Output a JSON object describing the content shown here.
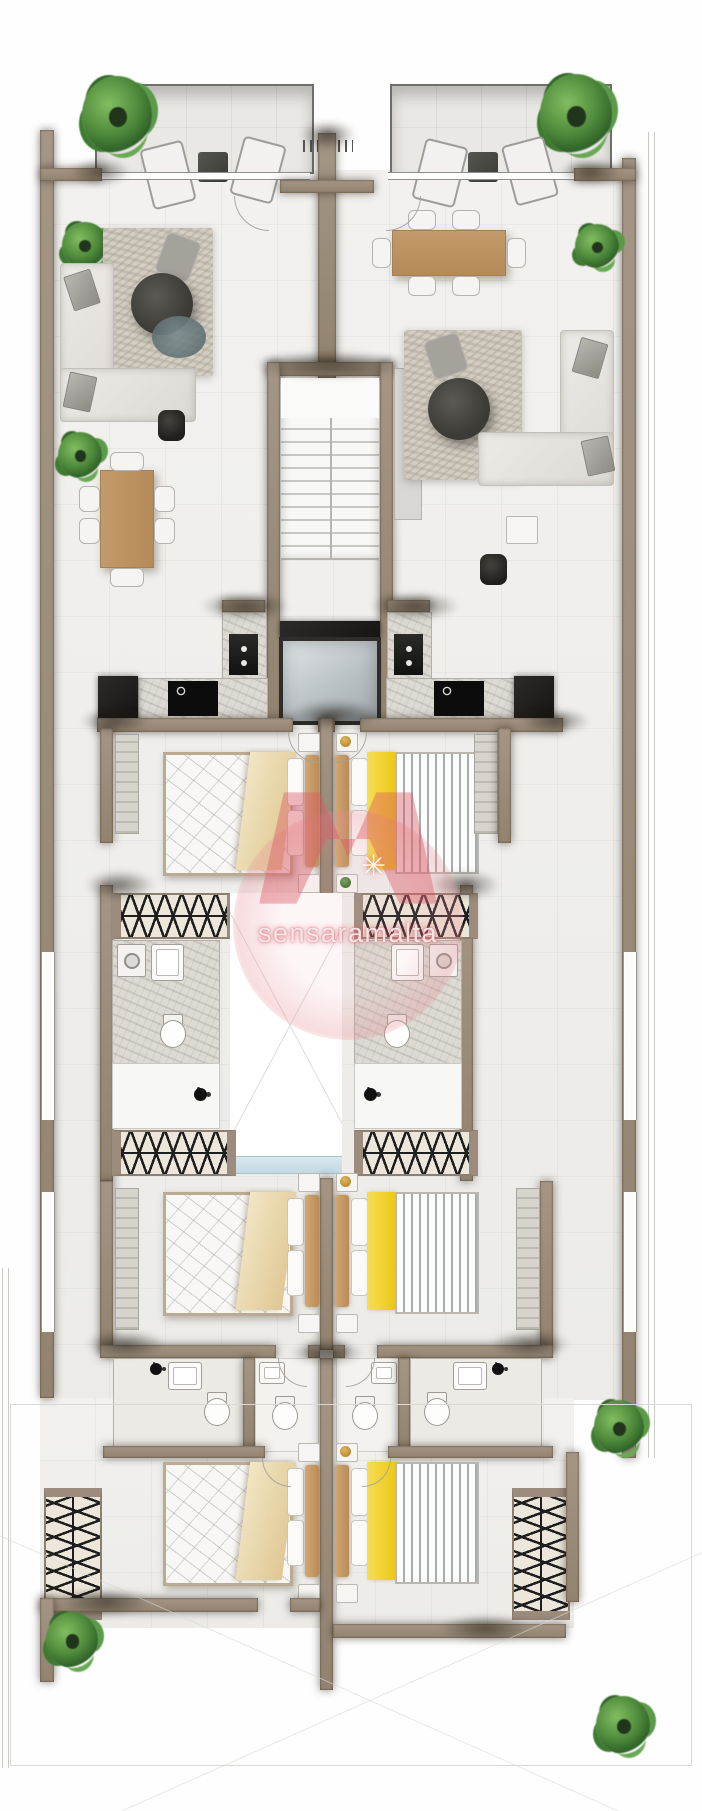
{
  "watermark": {
    "text": "sensaramalta",
    "star": "✳",
    "color": "#db5864"
  },
  "plan": {
    "type": "residential-floor-plan",
    "view": "top-down architectural render, two mirrored apartments around a central core",
    "core": [
      "staircase",
      "elevator",
      "light-well"
    ],
    "apartments": [
      {
        "id": "left",
        "rooms": [
          "terrace",
          "living-room",
          "dining-area",
          "kitchen",
          "bedroom-1",
          "walk-in-wardrobe",
          "bathroom-1",
          "bedroom-2",
          "bathroom-2",
          "bedroom-3"
        ],
        "furniture": [
          "potted-plant",
          "sun-lounger",
          "sun-lounger",
          "side-table",
          "corner-sofa",
          "rug",
          "round-coffee-table",
          "accent-chair",
          "floor-lamp",
          "dining-table-6-chairs",
          "fridge",
          "cooktop",
          "kitchen-sink",
          "double-bed-beige",
          "nightstands",
          "wardrobe-rails",
          "toilet",
          "washbasin",
          "washing-machine",
          "shower",
          "double-bed-beige-2",
          "bathroom-suite",
          "double-bed-beige-3",
          "tall-wardrobe"
        ]
      },
      {
        "id": "right",
        "rooms": [
          "terrace",
          "dining-area",
          "living-room",
          "kitchen",
          "bedroom-1",
          "walk-in-wardrobe",
          "bathroom-1",
          "bedroom-2",
          "bathroom-2",
          "bedroom-3"
        ],
        "furniture": [
          "potted-plant",
          "sun-lounger",
          "sun-lounger",
          "side-table",
          "dining-table-6-chairs",
          "corner-sofa",
          "rug",
          "round-coffee-table",
          "floor-lamp",
          "fridge",
          "cooktop",
          "kitchen-sink",
          "double-bed-yellow",
          "nightstands",
          "wardrobe-rails",
          "toilet",
          "washbasin",
          "washing-machine",
          "shower",
          "double-bed-yellow-2",
          "bathroom-suite",
          "double-bed-yellow-3",
          "tall-wardrobe"
        ]
      }
    ],
    "colors": {
      "wall": "#9b8c7d",
      "floor": "#f0efed",
      "terrace": "#e9e8e5",
      "marble": "#dcdad3",
      "appliance": "#1f1e1c",
      "elevator_cab": "#c2cacd",
      "bed_linen": "#f8f7f5",
      "blanket_beige": "#ead9ad",
      "blanket_yellow": "#f2d230",
      "wood": "#c39a6b",
      "plant": "#55913f",
      "accent_teal": "#68797d",
      "stair_tread": "#f4f4f2",
      "hatch_ink": "#262626",
      "watermark_pink": "#db5864"
    }
  }
}
